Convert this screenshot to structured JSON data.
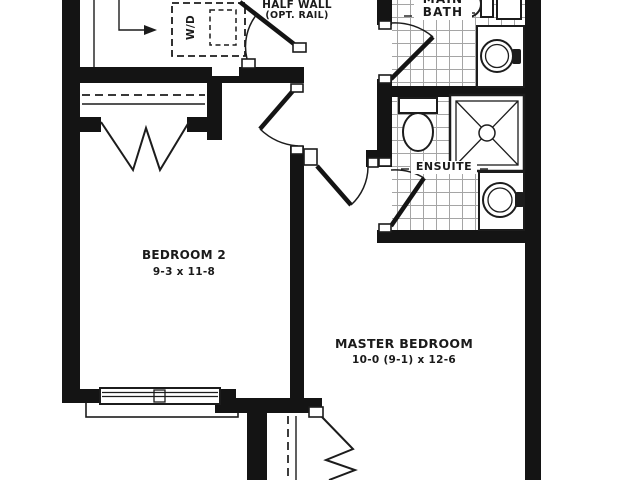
{
  "plan": {
    "rooms": {
      "bedroom2": {
        "name": "BEDROOM 2",
        "dims": "9-3 x 11-8"
      },
      "master_bedroom": {
        "name": "MASTER BEDROOM",
        "dims": "10-0 (9-1) x 12-6"
      },
      "main_bath": {
        "name_line1": "MAIN",
        "name_line2": "BATH"
      },
      "ensuite": {
        "name": "ENSUITE"
      }
    },
    "annotations": {
      "half_wall": {
        "line1": "HALF WALL",
        "line2": "(OPT. RAIL)"
      },
      "washer_dryer": "W/D"
    },
    "fixtures": [
      "toilet",
      "round-sink",
      "corner-shower",
      "washer-dryer",
      "double-window",
      "closet-rod",
      "bifold-doors",
      "door-swing",
      "stair-direction-arrow",
      "half-wall-rail"
    ],
    "colors": {
      "wall": "#141414",
      "line": "#1c1c1c",
      "tile": "#a5a5a5",
      "bg": "#ffffff",
      "text": "#1a1a1a"
    }
  }
}
